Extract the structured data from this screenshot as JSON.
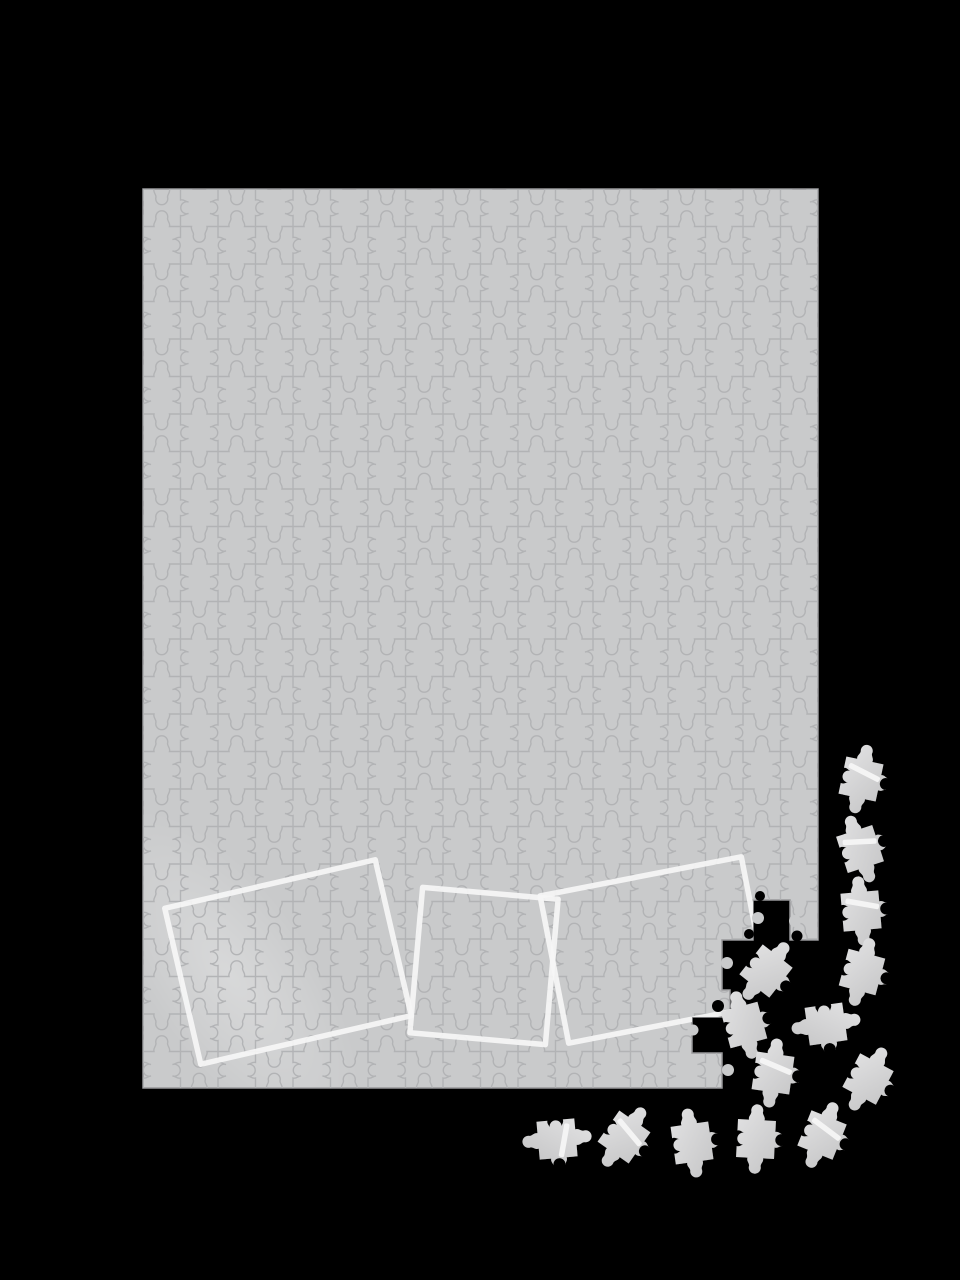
{
  "scene": {
    "kind": "jigsaw-puzzle-mockup",
    "canvas": {
      "width": 960,
      "height": 1280
    }
  },
  "colors": {
    "background": "#000000",
    "board_fill": "#c9cacb",
    "board_edge": "#97979a",
    "piece_line": "#b0b1b3",
    "frame_stroke": "#f6f6f6",
    "piece_light": "#e3e3e4",
    "piece_dark": "#c2c2c3",
    "sheen": "#ffffff"
  },
  "board": {
    "x": 143,
    "y": 189,
    "width": 675,
    "height": 899,
    "piece_size": 37.5,
    "columns": 18,
    "rows": 24,
    "outline_path": "M143,189 H818 V940 H790 V900 H753 V940 H722 V990 H730 V1017 H692 V1053 H722 V1088 H143 Z",
    "edge_knobs": [
      {
        "cx": 758,
        "cy": 918,
        "r": 6,
        "on": "board"
      },
      {
        "cx": 749,
        "cy": 934,
        "r": 5,
        "on": "bg"
      },
      {
        "cx": 795,
        "cy": 921,
        "r": 6,
        "on": "board"
      },
      {
        "cx": 760,
        "cy": 896,
        "r": 5,
        "on": "bg"
      },
      {
        "cx": 797,
        "cy": 936,
        "r": 5.5,
        "on": "bg"
      },
      {
        "cx": 727,
        "cy": 963,
        "r": 6,
        "on": "board"
      },
      {
        "cx": 718,
        "cy": 1006,
        "r": 6,
        "on": "bg"
      },
      {
        "cx": 700,
        "cy": 1046,
        "r": 6,
        "on": "bg"
      },
      {
        "cx": 728,
        "cy": 1070,
        "r": 6,
        "on": "board"
      },
      {
        "cx": 693,
        "cy": 1030,
        "r": 5.5,
        "on": "board"
      }
    ]
  },
  "sheen": {
    "cx": 230,
    "cy": 975,
    "rx": 82,
    "ry": 195,
    "transform": "rotate(-35 230 975)",
    "opacity": "0.5"
  },
  "frames": [
    {
      "cx": 288,
      "cy": 962,
      "width": 216,
      "height": 160,
      "rotation": -13
    },
    {
      "cx": 484,
      "cy": 966,
      "width": 136,
      "height": 146,
      "rotation": 5
    },
    {
      "cx": 655,
      "cy": 950,
      "width": 205,
      "height": 150,
      "rotation": -11
    }
  ],
  "frame_stroke_width": 5.5,
  "pieces": [
    {
      "x": 861,
      "y": 779,
      "rotation": 12,
      "stripe": true
    },
    {
      "x": 860,
      "y": 849,
      "rotation": -18,
      "stripe": true
    },
    {
      "x": 861,
      "y": 911,
      "rotation": -5,
      "stripe": true
    },
    {
      "x": 862,
      "y": 972,
      "rotation": 15,
      "stripe": false
    },
    {
      "x": 826,
      "y": 1024,
      "rotation": 82,
      "stripe": false
    },
    {
      "x": 868,
      "y": 1079,
      "rotation": 28,
      "stripe": false
    },
    {
      "x": 766,
      "y": 971,
      "rotation": 38,
      "stripe": false
    },
    {
      "x": 744,
      "y": 1025,
      "rotation": -15,
      "stripe": false
    },
    {
      "x": 773,
      "y": 1073,
      "rotation": 8,
      "stripe": true
    },
    {
      "x": 557,
      "y": 1139,
      "rotation": 85,
      "stripe": true
    },
    {
      "x": 624,
      "y": 1137,
      "rotation": 35,
      "stripe": true
    },
    {
      "x": 692,
      "y": 1143,
      "rotation": -8,
      "stripe": false
    },
    {
      "x": 756,
      "y": 1139,
      "rotation": 3,
      "stripe": false
    },
    {
      "x": 822,
      "y": 1135,
      "rotation": 22,
      "stripe": true
    }
  ]
}
